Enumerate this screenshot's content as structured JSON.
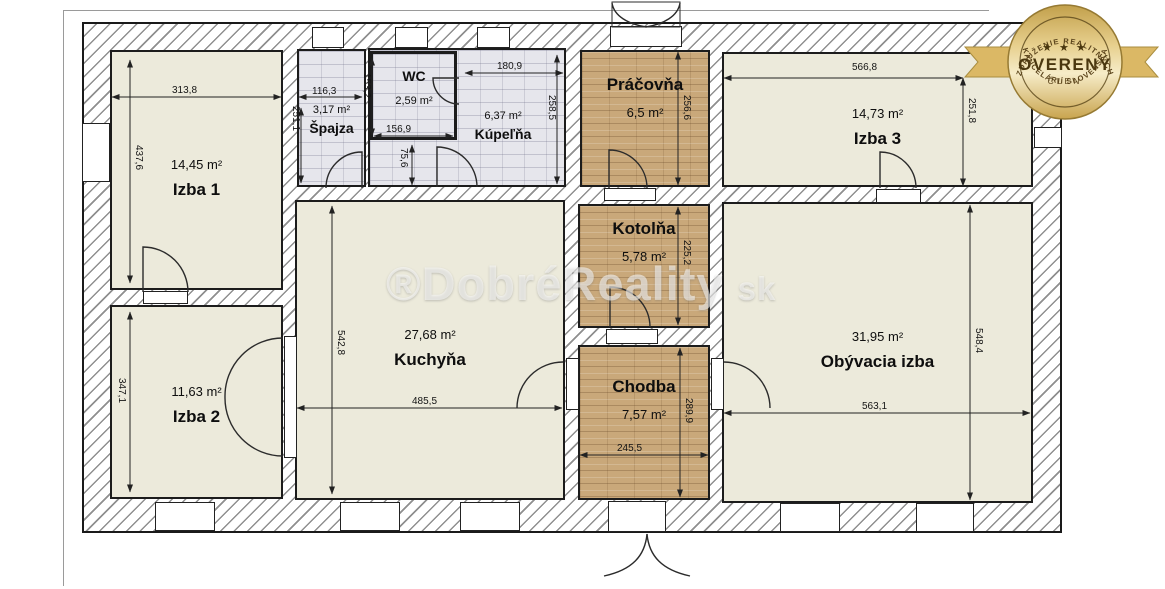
{
  "watermark": {
    "main": "®DobréReality",
    "suffix": "sk"
  },
  "badge": {
    "top_arc": "ZDRUŽENIE REALITNÝCH",
    "bottom_arc": "KANCELÁRIÍ SLOVENSKA",
    "stars": "★ ★ ★",
    "title": "OVERENÝ",
    "subtitle": "ČLEN",
    "gold": "#c9a44e",
    "ribbon": "#dbb865"
  },
  "rooms": {
    "izba1": {
      "name": "Izba 1",
      "area": "14,45 m²",
      "width": "313,8",
      "height": "437,6"
    },
    "izba2": {
      "name": "Izba 2",
      "area": "11,63 m²",
      "height": "347,1"
    },
    "spajza": {
      "name": "Špajza",
      "area": "3,17 m²",
      "width": "116,3",
      "height": "251,1"
    },
    "wc": {
      "name": "WC",
      "area": "2,59 m²",
      "width": "156,9",
      "height": "153,2"
    },
    "kupelna": {
      "name": "Kúpeľňa",
      "area": "6,37 m²",
      "width": "180,9",
      "height": "258,5",
      "sub": "75,6"
    },
    "pracovna": {
      "name": "Práčovňa",
      "area": "6,5 m²",
      "height": "256,6"
    },
    "izba3": {
      "name": "Izba 3",
      "area": "14,73 m²",
      "width": "566,8",
      "height": "251,8"
    },
    "kotolna": {
      "name": "Kotolňa",
      "area": "5,78 m²",
      "height": "225,2"
    },
    "kuchyna": {
      "name": "Kuchyňa",
      "area": "27,68 m²",
      "width": "485,5",
      "height": "542,8"
    },
    "chodba": {
      "name": "Chodba",
      "area": "7,57 m²",
      "width": "245,5",
      "height": "289,9"
    },
    "obyvacia": {
      "name": "Obývacia izba",
      "area": "31,95 m²",
      "width": "563,1",
      "height": "548,4"
    }
  }
}
